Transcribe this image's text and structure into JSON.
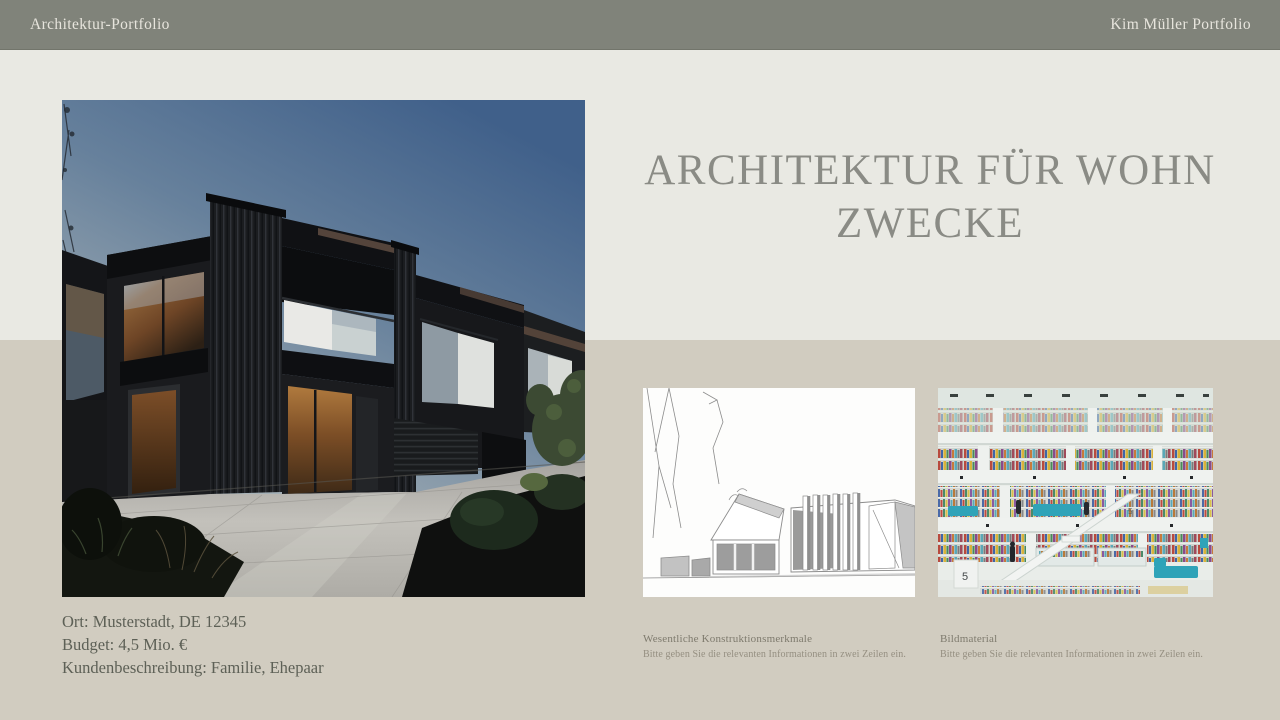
{
  "header": {
    "left_label": "Architektur-Portfolio",
    "right_label": "Kim Müller Portfolio"
  },
  "title": {
    "line1": "ARCHITEKTUR FÜR WOHN",
    "line2": "ZWECKE"
  },
  "project_info": {
    "lines": [
      "Ort: Musterstadt, DE 12345",
      "Budget: 4,5 Mio. €",
      "Kundenbeschreibung: Familie, Ehepaar"
    ]
  },
  "figures": {
    "hero": {
      "image_name": "dark-modern-residential-building-photo"
    },
    "left": {
      "image_name": "architectural-line-sketch",
      "caption": "Wesentliche Konstruktionsmerkmale",
      "subcaption": "Bitte geben Sie die relevanten Informationen in zwei Zeilen ein."
    },
    "right": {
      "image_name": "library-atrium-interior-photo",
      "caption": "Bildmaterial",
      "subcaption": "Bitte geben Sie die relevanten Informationen in zwei Zeilen ein.",
      "sign_label": "5"
    }
  },
  "colors": {
    "header_bg": "#80837A",
    "upper_bg": "#E9E9E3",
    "lower_bg": "#D1CCC0",
    "title_text": "#8A8B85",
    "body_text": "#5D6056",
    "caption_text": "#7E7A6D",
    "subcaption_text": "#958F81",
    "accent_teal": "#2FA3B8"
  }
}
